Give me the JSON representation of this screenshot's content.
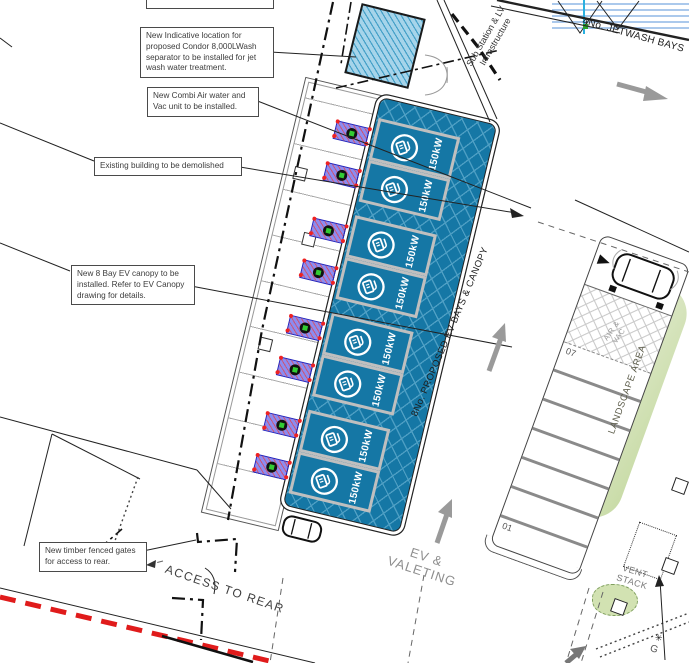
{
  "theme": {
    "colors": {
      "ev_blue": "#1577A5",
      "ev_hatch": "#4E9FC4",
      "bay_border": "#BFBFBF",
      "separator_fill": "#A6D4EA",
      "separator_hatch": "#45A0C8",
      "red_line": "#E01B1B",
      "arrow_gray": "#9A9A9A",
      "text_gray": "#8E8E8E",
      "jetwash_blue": "#8FB7E6"
    }
  },
  "annotations": {
    "partial": "to be installed",
    "condor": "New Indicative location for proposed Condor 8,000LWash separator to be installed for jet wash water treatment.",
    "combi": "New Combi Air water and Vac unit to be installed.",
    "demolish": "Existing building to be demolished",
    "canopy": "New 8 Bay EV canopy to be installed. Refer to EV Canopy drawing for details.",
    "gates": "New timber fenced gates for access to rear."
  },
  "labels": {
    "ev_bays_canopy": "8No. PROPOSED EV BAYS & CANOPY",
    "ev_valeting_line1": "EV &",
    "ev_valeting_line2": "VALETING",
    "access_rear": "ACCESS TO REAR",
    "jetwash": "4No. JETWASH BAYS",
    "substation_line1": "Sub Station & LV",
    "substation_line2": "Infrastructure",
    "landscape": "LANDSCAPE AREA",
    "vent_line1": "VENT",
    "vent_line2": "STACK",
    "airvac_line1": "AIR &",
    "airvac_line2": "VAC",
    "g_label": "G"
  },
  "icons": {
    "star": "✳"
  },
  "ev_bays": [
    {
      "power": "150kW"
    },
    {
      "power": "150kW"
    },
    {
      "power": "150kW"
    },
    {
      "power": "150kW"
    },
    {
      "power": "150kW"
    },
    {
      "power": "150kW"
    },
    {
      "power": "150kW"
    },
    {
      "power": "150kW"
    }
  ],
  "cabinets": [
    {},
    {},
    {},
    {},
    {},
    {},
    {},
    {}
  ],
  "parking_bays": [
    {
      "num": "07"
    },
    {
      "num": ""
    },
    {
      "num": ""
    },
    {
      "num": ""
    },
    {
      "num": ""
    },
    {
      "num": ""
    },
    {
      "num": "01"
    }
  ]
}
